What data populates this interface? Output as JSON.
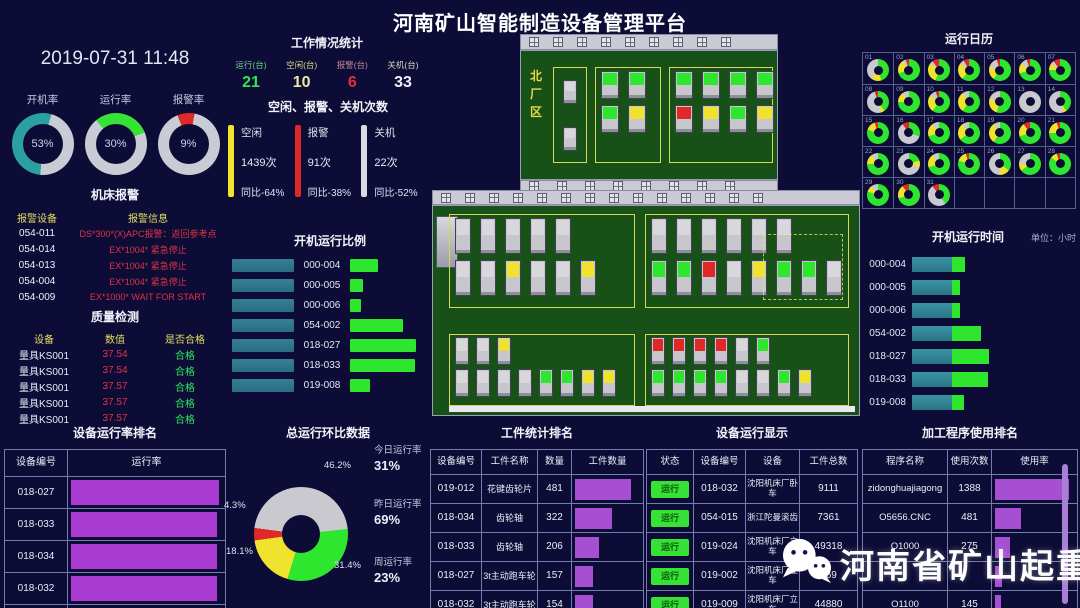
{
  "title": "河南矿山智能制造设备管理平台",
  "datetime": "2019-07-31 11:48",
  "gauges": [
    {
      "label": "开机率",
      "value": "53%",
      "pct": 53,
      "color": "#2aa0a0",
      "start": 185
    },
    {
      "label": "运行率",
      "value": "30%",
      "pct": 30,
      "color": "#35e235",
      "start": 320
    },
    {
      "label": "报警率",
      "value": "9%",
      "pct": 9,
      "color": "#e02828",
      "start": 338
    }
  ],
  "work_stats": {
    "title": "工作情况统计",
    "items": [
      {
        "label": "运行(台)",
        "value": "21",
        "label_color": "#6fcf8f",
        "value_color": "#2ce84c"
      },
      {
        "label": "空闲(台)",
        "value": "10",
        "label_color": "#d8d87f",
        "value_color": "#efe9a0"
      },
      {
        "label": "报警(台)",
        "value": "6",
        "label_color": "#c08a9a",
        "value_color": "#e03040"
      },
      {
        "label": "关机(台)",
        "value": "33",
        "label_color": "#d8d8c0",
        "value_color": "#f2f3fa"
      }
    ]
  },
  "counts_panel": {
    "title": "空闲、报警、关机次数",
    "items": [
      {
        "label": "空闲",
        "count": "1439次",
        "yoy": "同比-64%",
        "color": "#f0e42e"
      },
      {
        "label": "报警",
        "count": "91次",
        "yoy": "同比-38%",
        "color": "#e02828"
      },
      {
        "label": "关机",
        "count": "22次",
        "yoy": "同比-52%",
        "color": "#d9dae2"
      }
    ]
  },
  "machine_alarms": {
    "title": "机床报警",
    "headers": [
      "报警设备",
      "报警信息"
    ],
    "rows": [
      {
        "device": "054-011",
        "info": "DS*300*(X)APC报警：返回参考点"
      },
      {
        "device": "054-014",
        "info": "EX*1004* 紧急停止"
      },
      {
        "device": "054-013",
        "info": "EX*1004* 紧急停止"
      },
      {
        "device": "054-004",
        "info": "EX*1004* 紧急停止"
      },
      {
        "device": "054-009",
        "info": "EX*1000* WAIT FOR START"
      }
    ]
  },
  "quality": {
    "title": "质量检测",
    "headers": [
      "设备",
      "数值",
      "是否合格"
    ],
    "rows": [
      {
        "device": "量具KS001",
        "value": "37.54",
        "pass": "合格"
      },
      {
        "device": "量具KS001",
        "value": "37.54",
        "pass": "合格"
      },
      {
        "device": "量具KS001",
        "value": "37.57",
        "pass": "合格"
      },
      {
        "device": "量具KS001",
        "value": "37.57",
        "pass": "合格"
      },
      {
        "device": "量具KS001",
        "value": "37.57",
        "pass": "合格"
      }
    ]
  },
  "startup_ratio": {
    "title": "开机运行比例",
    "rows": [
      {
        "label": "000-004",
        "run": 0.42
      },
      {
        "label": "000-005",
        "run": 0.2
      },
      {
        "label": "000-006",
        "run": 0.17
      },
      {
        "label": "054-002",
        "run": 0.8
      },
      {
        "label": "018-027",
        "run": 1.0
      },
      {
        "label": "018-033",
        "run": 0.99
      },
      {
        "label": "019-008",
        "run": 0.3
      }
    ]
  },
  "device_rate_rank": {
    "title": "设备运行率排名",
    "headers": [
      "设备编号",
      "运行率"
    ],
    "rows": [
      {
        "id": "018-027",
        "rate": 0.98
      },
      {
        "id": "018-033",
        "rate": 0.97
      },
      {
        "id": "018-034",
        "rate": 0.97
      },
      {
        "id": "018-032",
        "rate": 0.97
      },
      {
        "id": "013-030",
        "rate": 0.86
      }
    ]
  },
  "total_ring": {
    "title": "总运行环比数据",
    "start_deg": 262,
    "slices": [
      {
        "label": "4.3%",
        "value": 4.3,
        "color": "#e02828"
      },
      {
        "label": "46.2%",
        "value": 46.2,
        "color": "#c9c9cf"
      },
      {
        "label": "31.4%",
        "value": 31.4,
        "color": "#2ee62e"
      },
      {
        "label": "18.1%",
        "value": 18.1,
        "color": "#f0e32e"
      }
    ],
    "side_stats": [
      {
        "label": "今日运行率",
        "value": "31%"
      },
      {
        "label": "昨日运行率",
        "value": "69%"
      },
      {
        "label": "周运行率",
        "value": "23%"
      }
    ]
  },
  "calendar": {
    "title": "运行日历",
    "days": [
      {
        "d": "01",
        "seg": [
          45,
          15,
          40,
          0
        ]
      },
      {
        "d": "02",
        "seg": [
          70,
          20,
          5,
          5
        ]
      },
      {
        "d": "03",
        "seg": [
          55,
          30,
          5,
          10
        ]
      },
      {
        "d": "04",
        "seg": [
          60,
          25,
          7,
          8
        ]
      },
      {
        "d": "05",
        "seg": [
          60,
          20,
          15,
          5
        ]
      },
      {
        "d": "06",
        "seg": [
          70,
          15,
          10,
          5
        ]
      },
      {
        "d": "07",
        "seg": [
          75,
          10,
          5,
          10
        ]
      },
      {
        "d": "08",
        "seg": [
          40,
          5,
          50,
          5
        ]
      },
      {
        "d": "09",
        "seg": [
          75,
          15,
          10,
          0
        ]
      },
      {
        "d": "10",
        "seg": [
          60,
          25,
          10,
          5
        ]
      },
      {
        "d": "11",
        "seg": [
          60,
          30,
          10,
          0
        ]
      },
      {
        "d": "12",
        "seg": [
          55,
          25,
          20,
          0
        ]
      },
      {
        "d": "13",
        "seg": [
          0,
          0,
          100,
          0
        ]
      },
      {
        "d": "14",
        "seg": [
          40,
          5,
          55,
          0
        ]
      },
      {
        "d": "15",
        "seg": [
          80,
          15,
          0,
          5
        ]
      },
      {
        "d": "16",
        "seg": [
          30,
          0,
          60,
          10
        ]
      },
      {
        "d": "17",
        "seg": [
          70,
          20,
          10,
          0
        ]
      },
      {
        "d": "18",
        "seg": [
          65,
          25,
          10,
          0
        ]
      },
      {
        "d": "19",
        "seg": [
          60,
          30,
          10,
          0
        ]
      },
      {
        "d": "20",
        "seg": [
          70,
          20,
          0,
          10
        ]
      },
      {
        "d": "21",
        "seg": [
          75,
          20,
          0,
          5
        ]
      },
      {
        "d": "22",
        "seg": [
          75,
          15,
          10,
          0
        ]
      },
      {
        "d": "23",
        "seg": [
          20,
          10,
          70,
          0
        ]
      },
      {
        "d": "24",
        "seg": [
          70,
          20,
          10,
          0
        ]
      },
      {
        "d": "25",
        "seg": [
          80,
          15,
          0,
          5
        ]
      },
      {
        "d": "26",
        "seg": [
          35,
          15,
          50,
          0
        ]
      },
      {
        "d": "27",
        "seg": [
          65,
          10,
          25,
          0
        ]
      },
      {
        "d": "28",
        "seg": [
          85,
          10,
          0,
          5
        ]
      },
      {
        "d": "29",
        "seg": [
          80,
          10,
          10,
          0
        ]
      },
      {
        "d": "30",
        "seg": [
          70,
          20,
          0,
          10
        ]
      },
      {
        "d": "31",
        "seg": [
          40,
          0,
          50,
          10
        ]
      }
    ],
    "seg_colors": [
      "#2ee62e",
      "#f0e32e",
      "#c9c9cf",
      "#e02828"
    ]
  },
  "runtime_chart": {
    "title": "开机运行时间",
    "unit": "单位：小时",
    "rows": [
      {
        "label": "000-004",
        "run": 0.33
      },
      {
        "label": "000-005",
        "run": 0.2
      },
      {
        "label": "000-006",
        "run": 0.2
      },
      {
        "label": "054-002",
        "run": 0.72
      },
      {
        "label": "018-027",
        "run": 0.92
      },
      {
        "label": "018-033",
        "run": 0.9
      },
      {
        "label": "019-008",
        "run": 0.31
      }
    ]
  },
  "workpiece_rank": {
    "title": "工件统计排名",
    "headers": [
      "设备编号",
      "工件名称",
      "数量",
      "工件数量"
    ],
    "rows": [
      {
        "id": "019-012",
        "name": "花键齿轮片",
        "count": "481",
        "ratio": 1.0
      },
      {
        "id": "018-034",
        "name": "齿轮轴",
        "count": "322",
        "ratio": 0.66
      },
      {
        "id": "018-033",
        "name": "齿轮轴",
        "count": "206",
        "ratio": 0.43
      },
      {
        "id": "018-027",
        "name": "3t主动跑车轮",
        "count": "157",
        "ratio": 0.33
      },
      {
        "id": "018-032",
        "name": "3t主动跑车轮",
        "count": "154",
        "ratio": 0.32
      }
    ]
  },
  "device_display": {
    "title": "设备运行显示",
    "headers": [
      "状态",
      "设备编号",
      "设备",
      "工件总数"
    ],
    "rows": [
      {
        "status": "运行",
        "id": "018-032",
        "device": "沈阳机床厂卧车",
        "total": "9111"
      },
      {
        "status": "运行",
        "id": "054-015",
        "device": "浙江陀曼滚齿",
        "total": "7361"
      },
      {
        "status": "运行",
        "id": "019-024",
        "device": "沈阳机床厂立车",
        "total": "49318"
      },
      {
        "status": "运行",
        "id": "019-002",
        "device": "沈阳机床厂立车",
        "total": "469"
      },
      {
        "status": "运行",
        "id": "019-009",
        "device": "沈阳机床厂立车",
        "total": "44880"
      }
    ]
  },
  "program_rank": {
    "title": "加工程序使用排名",
    "headers": [
      "程序名称",
      "使用次数",
      "使用率"
    ],
    "rows": [
      {
        "name": "zidonghuajiagong",
        "count": "1388",
        "ratio": 1.0
      },
      {
        "name": "O5656.CNC",
        "count": "481",
        "ratio": 0.35
      },
      {
        "name": "O1000",
        "count": "275",
        "ratio": 0.2
      },
      {
        "name": "",
        "count": "",
        "ratio": 0.1
      },
      {
        "name": "O1100",
        "count": "145",
        "ratio": 0.08
      }
    ]
  },
  "factory": {
    "north_label": "北厂区",
    "status_colors": {
      "green": "#2ee62e",
      "yellow": "#f0e32e",
      "red": "#e02828",
      "gray": "#d8d8dc"
    },
    "top_building": {
      "groups": [
        {
          "rows": [
            [
              "gray"
            ],
            [
              "gray"
            ]
          ]
        },
        {
          "rows": [
            [
              "green",
              "green"
            ],
            [
              "green",
              "yellow"
            ]
          ]
        },
        {
          "rows": [
            [
              "green",
              "green",
              "green",
              "green"
            ],
            [
              "red",
              "yellow",
              "green",
              "yellow"
            ]
          ]
        }
      ]
    },
    "main_building": {
      "zones": [
        {
          "id": "TL",
          "rows": [
            [
              "gray",
              "gray",
              "gray",
              "gray",
              "gray"
            ],
            [
              "gray",
              "gray",
              "yellow",
              "gray",
              "gray",
              "yellow"
            ]
          ]
        },
        {
          "id": "TR",
          "rows": [
            [
              "gray",
              "gray",
              "gray",
              "gray",
              "gray",
              "gray"
            ],
            [
              "green",
              "green",
              "red",
              "gray",
              "yellow",
              "green",
              "green",
              "gray"
            ]
          ]
        },
        {
          "id": "BL",
          "rows": [
            [
              "gray",
              "gray",
              "yellow"
            ],
            [
              "gray",
              "gray",
              "gray",
              "gray",
              "green",
              "green",
              "yellow",
              "yellow"
            ]
          ]
        },
        {
          "id": "BR",
          "rows": [
            [
              "red",
              "red",
              "red",
              "red",
              "gray",
              "green"
            ],
            [
              "green",
              "green",
              "green",
              "green",
              "gray",
              "gray",
              "green",
              "yellow"
            ]
          ]
        }
      ]
    }
  },
  "watermark": {
    "text": "河南省矿山起重机"
  }
}
